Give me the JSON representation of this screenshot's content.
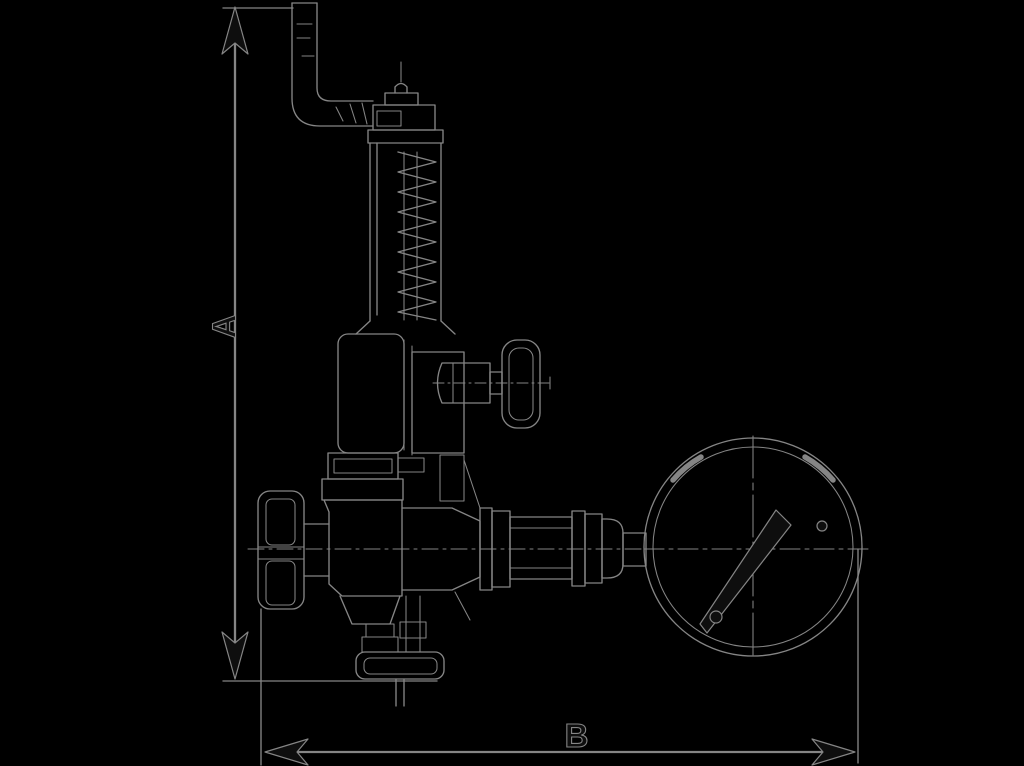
{
  "canvas": {
    "width": 1024,
    "height": 766,
    "background": "#000000"
  },
  "drawing": {
    "line_color": "#858585",
    "dark_fill_color": "#0e0e0e",
    "dimensions": {
      "vertical_label": "A",
      "horizontal_label": "B"
    }
  }
}
